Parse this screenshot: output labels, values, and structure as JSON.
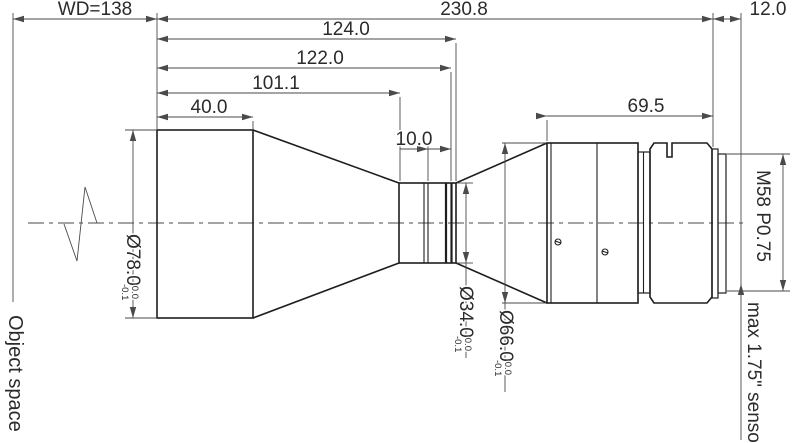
{
  "labels": {
    "object_space": "Object space",
    "sensor": "max 1.75\" sensor",
    "thread": "M58 P0.75"
  },
  "horizontal_dimensions": {
    "working_distance": "WD=138",
    "total_length": "230.8",
    "flange_to_sensor": "12.0",
    "front_to_rear_stop_outer": "124.0",
    "front_to_rear_stop_inner": "122.0",
    "front_to_waist": "101.1",
    "front_cell_length": "40.0",
    "waist_band_length": "10.0",
    "rear_group_length": "69.5"
  },
  "diameter_dimensions": {
    "front": {
      "value": "Ø78.0",
      "tol_upper": "0.0",
      "tol_lower": "-0.1"
    },
    "waist": {
      "value": "Ø34.0",
      "tol_upper": "0.0",
      "tol_lower": "-0.1"
    },
    "rear": {
      "value": "Ø66.0",
      "tol_upper": "0.0",
      "tol_lower": "-0.1"
    }
  },
  "colors": {
    "background": "#ffffff",
    "outline": "#1e1e1e",
    "dimension_lines": "#4a4a4a",
    "text": "#2b2b2b"
  }
}
